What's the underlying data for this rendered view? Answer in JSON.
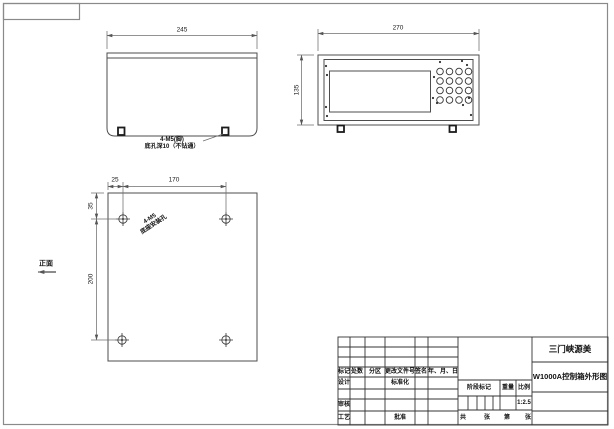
{
  "colors": {
    "frame": "#8a8a8a",
    "outline": "#4d4d4d",
    "dimension": "#6e6e6e",
    "text": "#111111",
    "background": "#ffffff"
  },
  "drawing": {
    "side_view": {
      "dim_width": "245",
      "note_line1": "4-M5(脚)",
      "note_line2": "底孔深10（不钻通）"
    },
    "front_view": {
      "dim_width": "270",
      "dim_height": "135"
    },
    "bottom_view": {
      "front_label": "正面",
      "dim_left_offset": "25",
      "dim_hole_span_h": "170",
      "dim_top_offset": "35",
      "dim_hole_span_v": "200",
      "note_line1": "4-M5",
      "note_line2": "底座安装孔"
    },
    "title_block": {
      "company": "三门峡源美",
      "drawing_title": "W1000A控制箱外形图",
      "header": [
        "标记",
        "处数",
        "分区",
        "更改文件号",
        "签名",
        "年、月、日"
      ],
      "design_label": "设计",
      "standardization_label": "标准化",
      "review_label": "审核",
      "process_label": "工艺",
      "approve_label": "批准",
      "stage_mark_label": "阶段标记",
      "weight_label": "重量",
      "scale_label": "比例",
      "scale_value": "1:2.5",
      "sheets": {
        "total_label": "共",
        "total_unit": "张",
        "no_label": "第",
        "no_unit": "张"
      }
    }
  }
}
